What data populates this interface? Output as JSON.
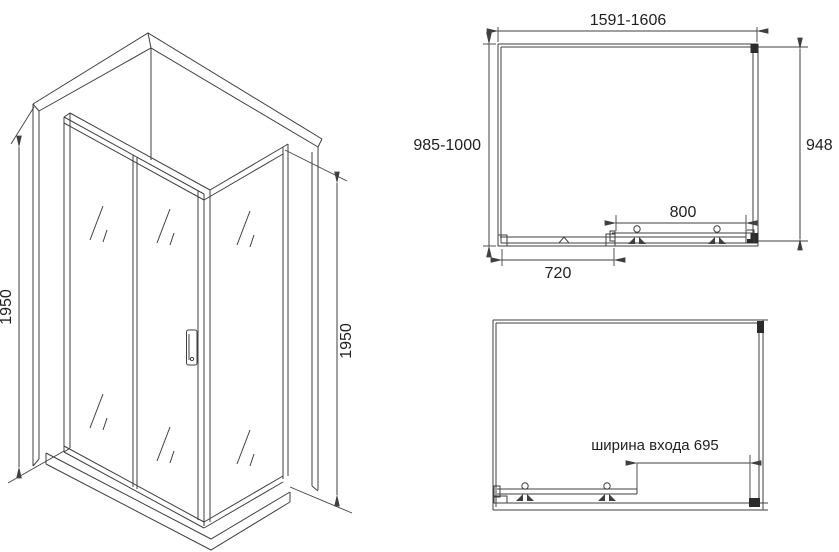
{
  "drawing_title": "shower-enclosure-technical-drawing",
  "colors": {
    "line": "#3f3f3f",
    "text": "#1f1f1f",
    "bracket_fill": "#2b2b2b",
    "background": "#ffffff"
  },
  "iso_view": {
    "height_left_label": "1950",
    "height_right_label": "1950"
  },
  "top_view": {
    "width_range_label": "1591-1606",
    "depth_range_label": "985-1000",
    "side_panel_label": "948",
    "door_width_label": "800",
    "fixed_panel_label": "720"
  },
  "plan_open_view": {
    "entrance_width_label": "ширина входа 695"
  }
}
